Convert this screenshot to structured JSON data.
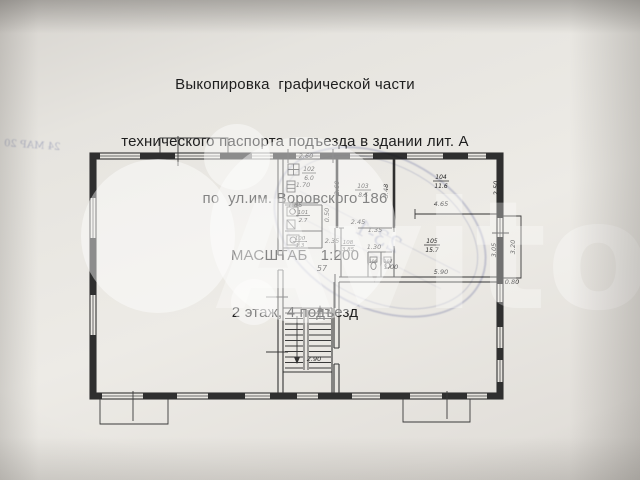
{
  "document": {
    "title_lines": [
      "Выкопировка  графической части",
      "технического паспорта подъезда в здании лит. А",
      "по  ул.им. Воровского 186",
      "МАСШТАБ   1:200",
      "2 этаж, 4 подъезд"
    ]
  },
  "plan": {
    "rooms": {
      "r100": {
        "number": "100",
        "area": "1.3"
      },
      "r101": {
        "number": "101",
        "area": "2.7"
      },
      "r102": {
        "number": "102",
        "area": "6.0"
      },
      "r103": {
        "number": "103",
        "area": "8.5"
      },
      "r104": {
        "number": "104",
        "area": "11.6"
      },
      "r105": {
        "number": "105",
        "area": "15.7"
      },
      "r106": {
        "number": "106"
      },
      "r107": {
        "number": "107"
      },
      "r108": {
        "number": "108",
        "area": "3.85"
      }
    },
    "dimensions": {
      "top_102": "2.60",
      "w_170": "1.70",
      "w_166": "1.66",
      "pass_050": "0.50",
      "w_235": "2.35",
      "v_260": "2.60",
      "v_348": "3.48",
      "w_245": "2.45",
      "w_135": "1.35",
      "w_130": "1.30",
      "w_465": "4.65",
      "v_250": "2.50",
      "v_305": "3.05",
      "v_320": "3.20",
      "w_590": "5.90",
      "w_080": "0.80",
      "w_100": "1.00",
      "stair_290": "2.90"
    },
    "labels": {
      "lobby": "57",
      "stair_flight": "А"
    }
  },
  "stamp": {
    "oval_text": "23-1",
    "date_text": "24 МАР 20"
  },
  "watermark": {
    "brand": "Avito"
  }
}
